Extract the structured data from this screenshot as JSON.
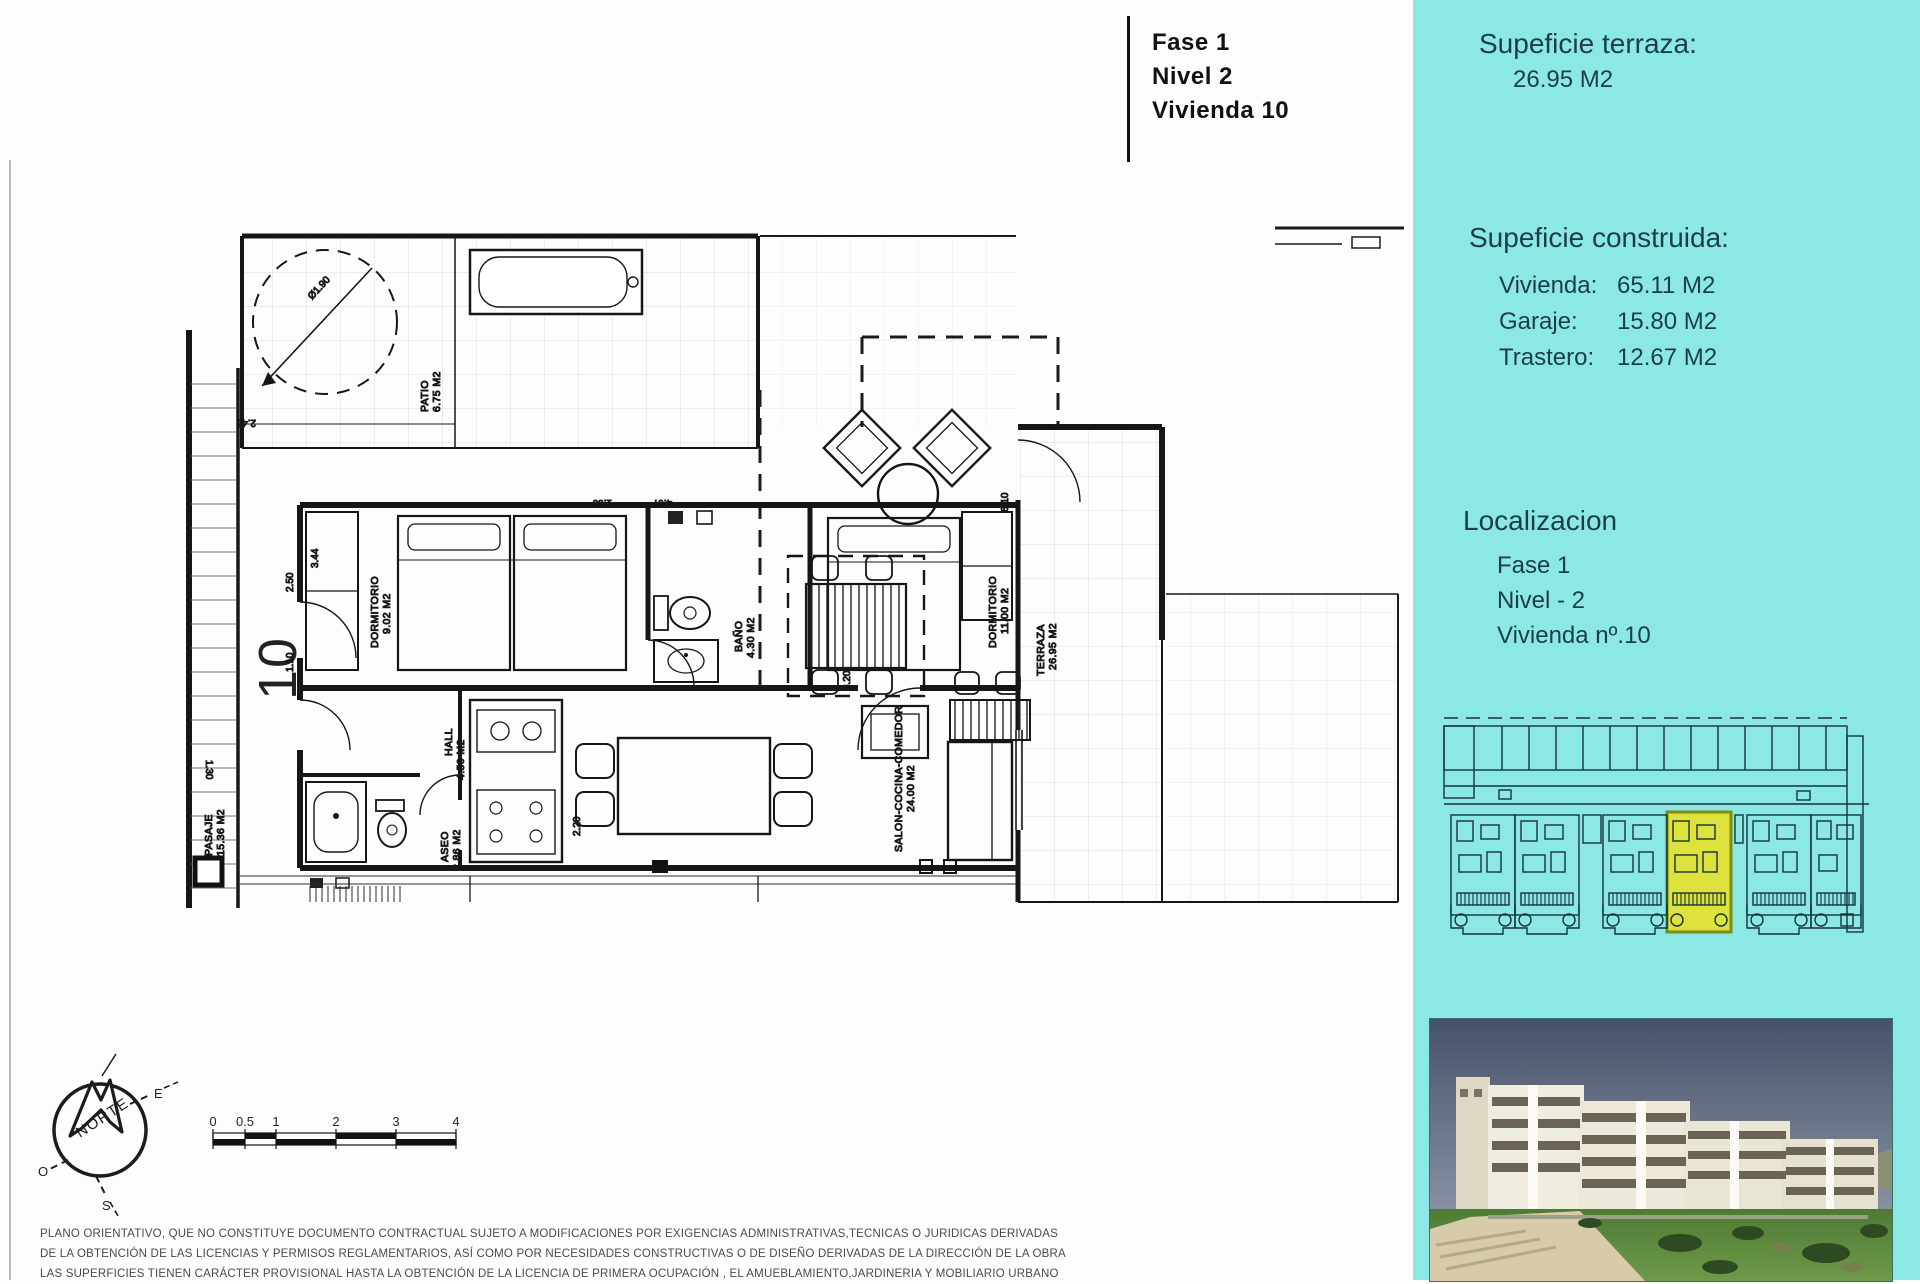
{
  "title_block": {
    "lines": [
      "Fase 1",
      "Nivel 2",
      "Vivienda  10"
    ]
  },
  "sidebar": {
    "bg_color": "#8BE8E5",
    "terraza_label": "Supeficie terraza:",
    "terraza_value": "26.95 M2",
    "construida_label": "Supeficie construida:",
    "construida_rows": [
      {
        "name": "Vivienda:",
        "value": "65.11 M2"
      },
      {
        "name": "Garaje:",
        "value": "15.80 M2"
      },
      {
        "name": "Trastero:",
        "value": "12.67 M2"
      }
    ],
    "localizacion_label": "Localizacion",
    "localizacion_lines": [
      "Fase 1",
      "Nivel - 2",
      "Vivienda nº.10"
    ],
    "siteplan_highlight_color": "#dde23d"
  },
  "plan": {
    "unit_number": "10",
    "rooms": {
      "patio": {
        "name": "PATIO",
        "area": "6.75 M2"
      },
      "dorm1": {
        "name": "DORMITORIO",
        "area": "9.02 M2"
      },
      "bano": {
        "name": "BAÑO",
        "area": "4.30 M2"
      },
      "dorm2": {
        "name": "DORMITORIO",
        "area": "11.00 M2"
      },
      "hall": {
        "name": "HALL",
        "area": "4.50 M2"
      },
      "aseo": {
        "name": "ASEO",
        "area": "2.86 M2"
      },
      "salon": {
        "name": "SALON-COCINA-COMEDOR",
        "area": "24.00 M2"
      },
      "terraza": {
        "name": "TERRAZA",
        "area": "26.95 M2"
      },
      "pasaje": {
        "name": "PASAJE",
        "area": "15.36 M2"
      }
    },
    "dimensions": {
      "w344": "3.44",
      "w250": "2.50",
      "w110": "1.10",
      "w246": "2.46",
      "w160": "1.60",
      "w407": "4.07",
      "w610": "6.10",
      "w320": "3.20",
      "w220": "2.20",
      "w130": "1.30",
      "dia": "Ø1.90"
    }
  },
  "compass": {
    "north": "NORTE",
    "east": "E",
    "west": "O",
    "south": "S"
  },
  "scale_bar": {
    "ticks": [
      "0",
      "0.5",
      "1",
      "2",
      "3",
      "4"
    ]
  },
  "disclaimer": {
    "lines": [
      "PLANO ORIENTATIVO, QUE NO CONSTITUYE DOCUMENTO CONTRACTUAL SUJETO A MODIFICACIONES POR EXIGENCIAS ADMINISTRATIVAS,TECNICAS O JURIDICAS DERIVADAS",
      "DE LA OBTENCIÓN DE LAS LICENCIAS Y PERMISOS REGLAMENTARIOS, ASÍ COMO POR NECESIDADES CONSTRUCTIVAS  O DE DISEÑO DERIVADAS DE LA DIRECCIÓN DE LA OBRA",
      "LAS SUPERFICIES TIENEN CARÁCTER PROVISIONAL HASTA LA OBTENCIÓN DE LA LICENCIA DE PRIMERA OCUPACIÓN , EL AMUEBLAMIENTO,JARDINERIA Y MOBILIARIO URBANO"
    ]
  }
}
